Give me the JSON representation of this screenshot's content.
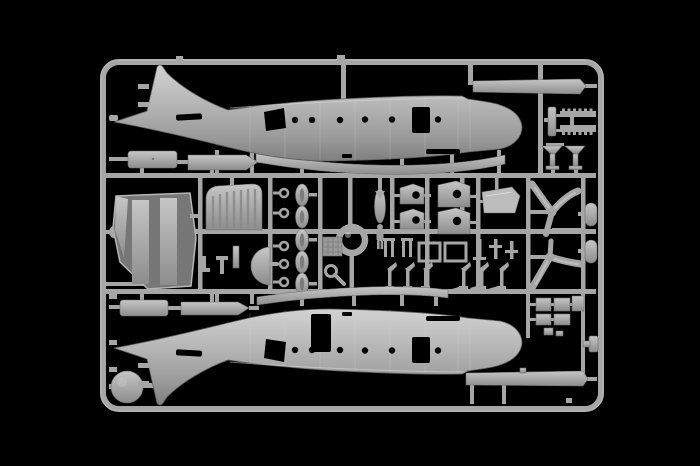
{
  "meta": {
    "type": "photograph",
    "scene": "plastic model kit sprue of an aircraft on black background",
    "alt": "Gray injection-molded plastic model kit sprue photographed on a black background. Two aircraft fuselage halves with porthole and door cutouts run along the top and bottom; between them the runner frame holds propellers, seats, bulkheads, engine pods, struts, a wheel disc and other small parts."
  },
  "colors": {
    "background": "#000000",
    "sprue": "#a6a6a6",
    "sprue_light": "#cdcdcd",
    "sprue_dark": "#6f6f6f",
    "part_dark": "#7a7a7a",
    "cutout": "#000000"
  },
  "parts_inventory": [
    {
      "name": "fuselage-half",
      "count": 2
    },
    {
      "name": "three-blade-propeller",
      "count": 2
    },
    {
      "name": "propeller-spinner",
      "count": 2
    },
    {
      "name": "cabin-bulkhead-floor",
      "count": 1
    },
    {
      "name": "ribbed-cowling-panel",
      "count": 1
    },
    {
      "name": "half-round-fairing",
      "count": 1
    },
    {
      "name": "crew-seat",
      "count": 4
    },
    {
      "name": "engine-pod-oval",
      "count": 5
    },
    {
      "name": "small-ring",
      "count": 5
    },
    {
      "name": "bomb-torpedo",
      "count": 1
    },
    {
      "name": "crew-figure",
      "count": 1
    },
    {
      "name": "loop-antenna-ring",
      "count": 1
    },
    {
      "name": "key-shaped-part",
      "count": 1
    },
    {
      "name": "cockpit-glazing-panel",
      "count": 1
    },
    {
      "name": "landing-gear-leg",
      "count": 6
    },
    {
      "name": "strut-bracket",
      "count": 5
    },
    {
      "name": "open-square-frame",
      "count": 2
    },
    {
      "name": "wheel-disc",
      "count": 1
    },
    {
      "name": "nacelle-strip",
      "count": 4
    },
    {
      "name": "wing-fairing-strip",
      "count": 2
    },
    {
      "name": "long-strip",
      "count": 2
    },
    {
      "name": "serrated-strip",
      "count": 2
    },
    {
      "name": "tail-support-bracket",
      "count": 2
    },
    {
      "name": "square-hatch",
      "count": 5
    }
  ]
}
